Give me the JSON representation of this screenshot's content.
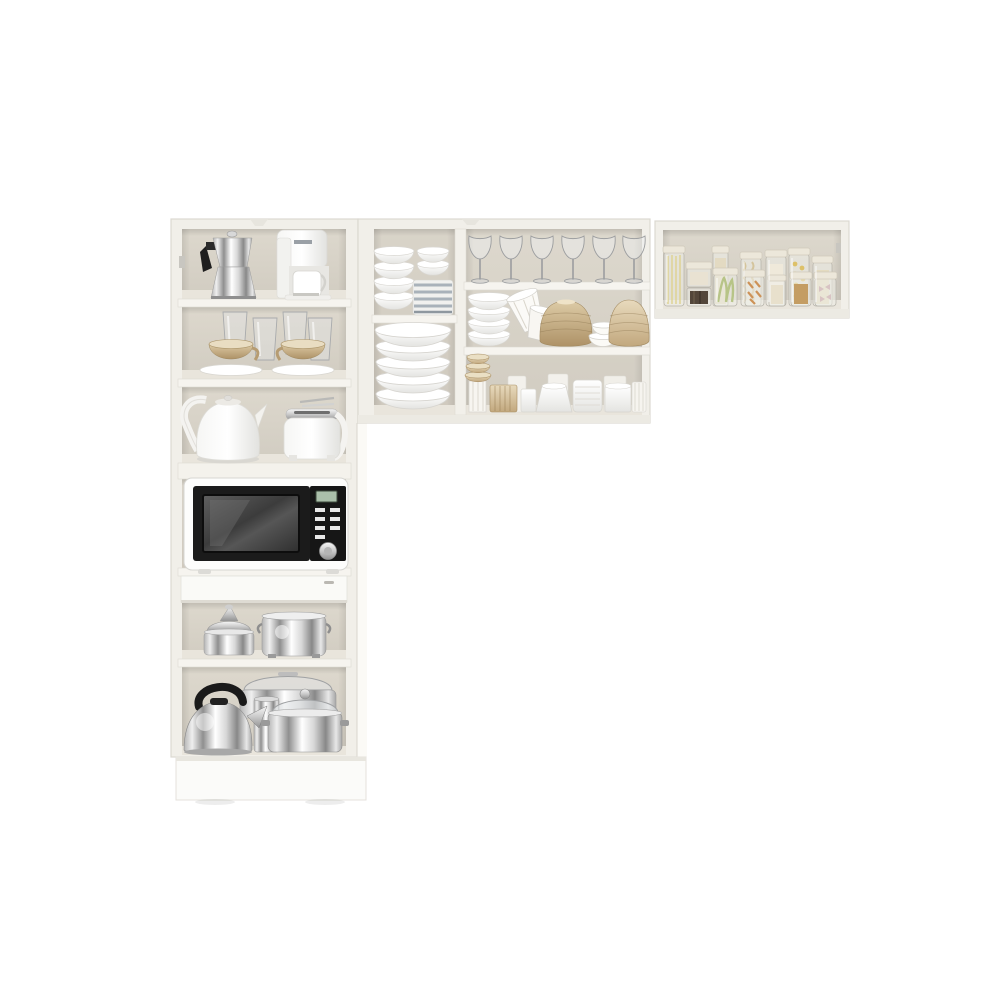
{
  "meta": {
    "description": "Product photo of a white 3-piece compact kitchen cabinet set shown on a plain white background: one tall pantry cabinet on the left filled with appliances and cookware, a wide double upper cabinet in the middle with dishware and wine glasses, and a single wide upper cabinet on the right holding glass pantry jars.",
    "background_color": "#ffffff"
  },
  "palette": {
    "cabinet_frame": "#f1efe9",
    "cabinet_edge": "#dcd9d1",
    "interior_back": "#d8d3c8",
    "shelf_face": "#f5f3ee",
    "chrome_light": "#f2f2f2",
    "chrome_dark": "#8a8a8a",
    "appliance_black": "#1c1c1c",
    "ceramic_white": "#ffffff",
    "champagne_tan": "#c9b28c",
    "stripe_blue_gray": "#a9b2ba",
    "lcd_green": "#aabfaa",
    "pasta_yellow": "#e6dca4",
    "pasta_green": "#c3cf92",
    "pasta_orange": "#d39a5e",
    "grain_dark": "#53463a"
  },
  "inventory_counts": {
    "wine_glasses": 6,
    "pantry_jars": 12,
    "white_bowl_stack_small_section": 4,
    "white_bowl_stack_large_section": 5,
    "ribbed_bowl_stack": 4,
    "glass_tumblers": 4,
    "teacups_with_saucers": 2
  },
  "cabinets": {
    "tall_left": {
      "label": "Tall white pantry cabinet with open shelves, microwave niche, drawer and base",
      "items": {
        "moka_pot": "Stainless steel moka espresso pot with black handle",
        "coffee_maker": "White drip coffee maker with carafe",
        "tumblers": "Four clear glass tumblers",
        "teacups": "Two champagne-gold teacups on white saucers",
        "kettle": "White electric kettle with arched handle",
        "toaster": "White toaster with chrome top",
        "microwave": "White microwave oven with black door, digital display and silver knob",
        "drawer": "White drawer front",
        "steamer_pot": "Polished steamer pot with domed juicer lid",
        "stock_pot": "Large stainless stock pot with side handles",
        "stove_kettle": "Chrome stovetop whistling kettle with black handle",
        "roasting_pan": "Stainless roasting pan with glass lid",
        "lidded_pot": "Stainless casserole pot with glass lid and handles",
        "canister": "Small chrome canister",
        "base": "White plinth base"
      }
    },
    "middle_upper": {
      "label": "Wide double upper wall cabinet with dishware",
      "items": {
        "bowl_stack_small": "Stack of four white bowls",
        "mini_bowls": "Two small white bowls",
        "striped_plates": "Stack of blue-gray striped plates",
        "bowl_stack_large": "Stack of five large white bowls",
        "wine_glasses": "Six clear wine glasses in a row",
        "ribbed_bowls": "Stack of four ribbed white bowls",
        "tilted_cups": "Two tilted pinstriped cups",
        "tan_vase_1": "Round ribbed tan vase",
        "tan_vase_2": "Round ribbed tan vase",
        "small_striped_bowls": "Pair of small pinstriped bowls",
        "goblet_stack": "Stacked tan cups on white ribbed pedestal",
        "cup_row": "Assorted white and tan cups and tumblers"
      }
    },
    "right_upper": {
      "label": "Single wide upper wall cabinet with glass pantry jars",
      "jars": [
        {
          "content": "Spaghetti (pale yellow)"
        },
        {
          "content": "Small white pasta"
        },
        {
          "content": "Dark grains"
        },
        {
          "content": "Rolled oats"
        },
        {
          "content": "Green fettuccine ribbons"
        },
        {
          "content": "Fusilli (beige)"
        },
        {
          "content": "Orange penne"
        },
        {
          "content": "White rice"
        },
        {
          "content": "Yellow macaroni"
        },
        {
          "content": "Brown lentils"
        },
        {
          "content": "Pale shell pasta"
        },
        {
          "content": "Farfalle bows (mixed)"
        }
      ]
    }
  }
}
